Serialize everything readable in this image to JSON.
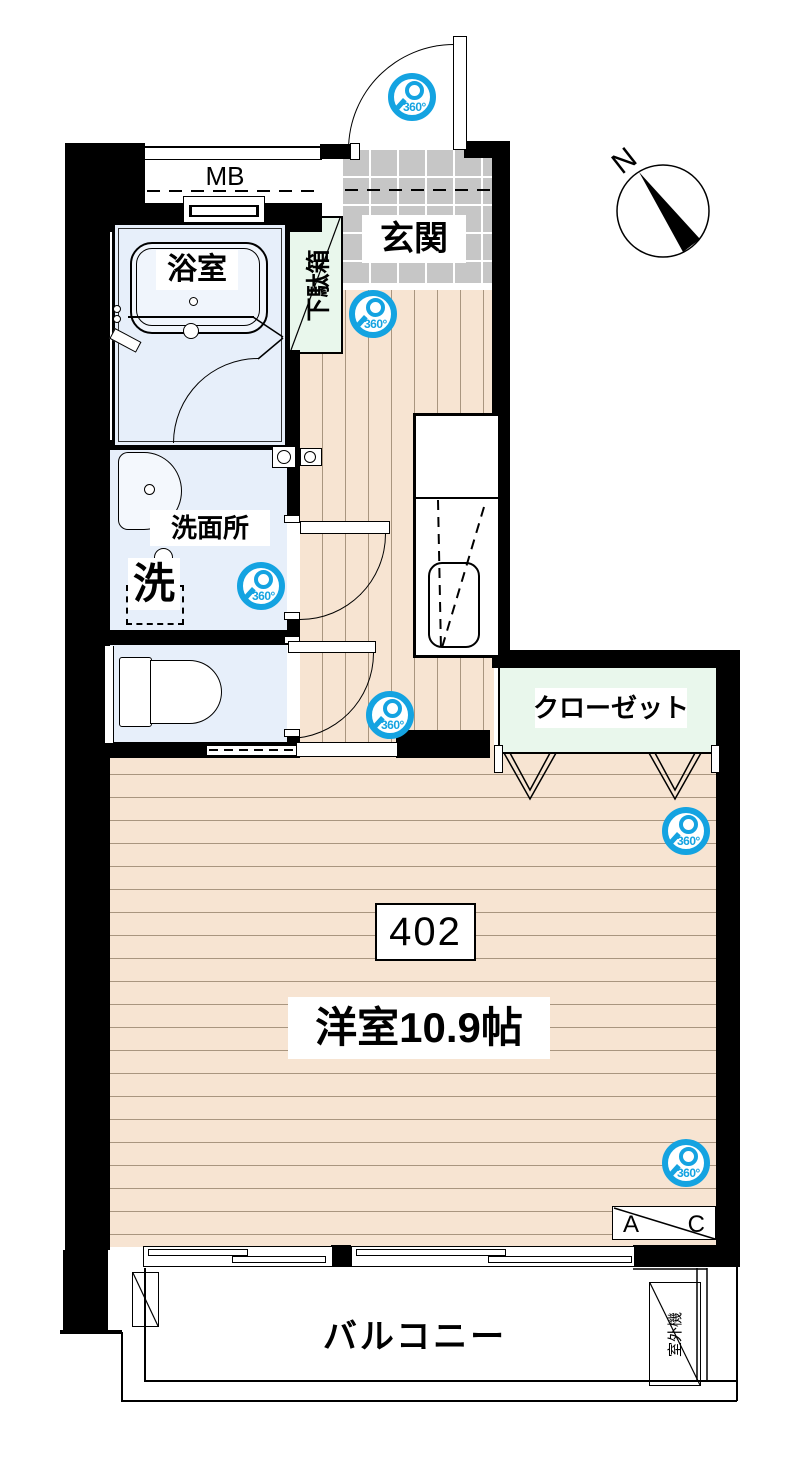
{
  "unit": {
    "number": "402",
    "main_room": "洋室10.9帖"
  },
  "rooms": {
    "meter_box": "MB",
    "bathroom": "浴室",
    "shoe_cabinet": "下駄箱",
    "entrance": "玄関",
    "washroom": "洗面所",
    "laundry": "洗",
    "closet": "クローゼット",
    "balcony": "バルコニー"
  },
  "equipment": {
    "outdoor_unit": "室外機",
    "ac_left": "A",
    "ac_right": "C"
  },
  "compass": {
    "north": "N"
  },
  "camera": {
    "label": "360°"
  },
  "colors": {
    "wall": "#000000",
    "wood_floor": "#f7e4d2",
    "tile_floor": "#c6c6c6",
    "wet_floor": "#e7effa",
    "storage_green": "#e9f7ec",
    "camera_blue": "#14a3e1"
  }
}
